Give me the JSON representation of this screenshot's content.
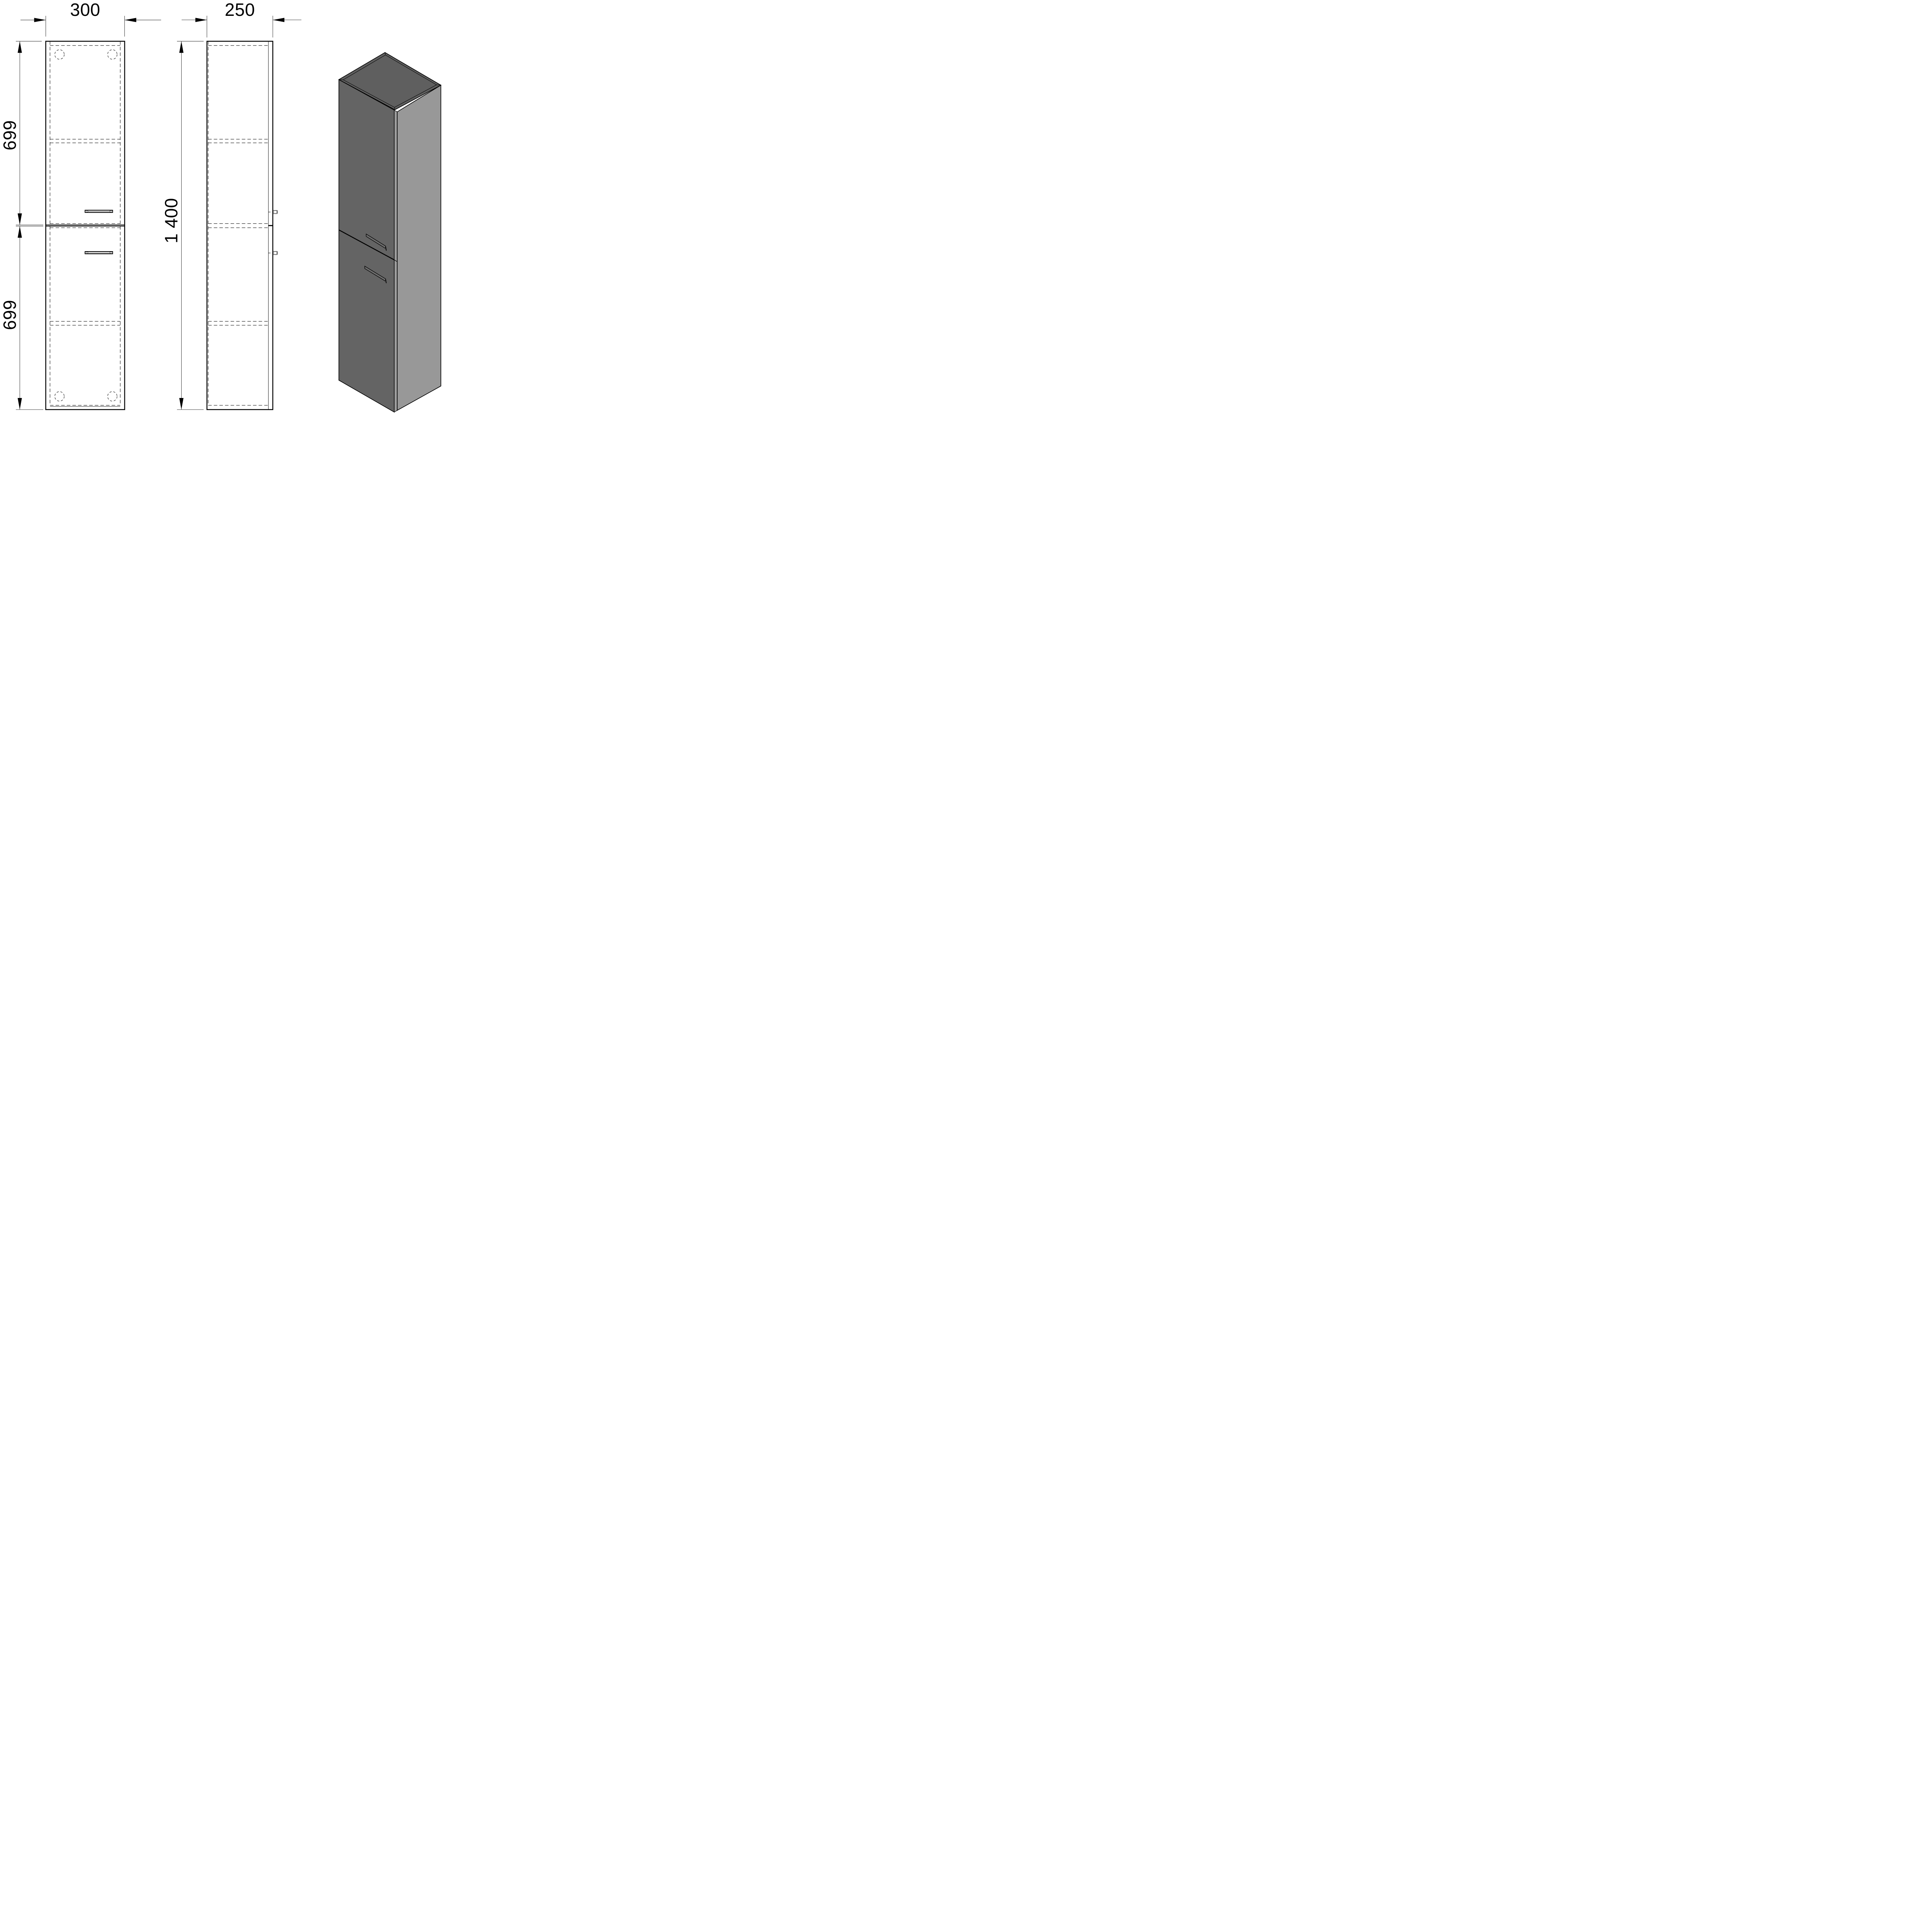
{
  "drawing": {
    "type": "technical-drawing",
    "subject": "tall two-door cabinet",
    "background": "#ffffff",
    "line_color": "#000000",
    "dimensions": {
      "front_width": "300",
      "side_depth": "250",
      "total_height": "1 400",
      "upper_section_height": "699",
      "lower_section_height": "699"
    },
    "views": {
      "front_view": "front elevation with two doors, handles, shelves and mounting holes",
      "side_view": "side elevation with door panel and protruding handles",
      "iso_view": "isometric 3d render"
    },
    "colors": {
      "iso_front_face": "#646464",
      "iso_top_face": "#5f5f5f",
      "iso_side_face": "#989898",
      "iso_edge_strip": "#9c9c9c",
      "iso_handle_cap": "#c8c8c8"
    }
  }
}
